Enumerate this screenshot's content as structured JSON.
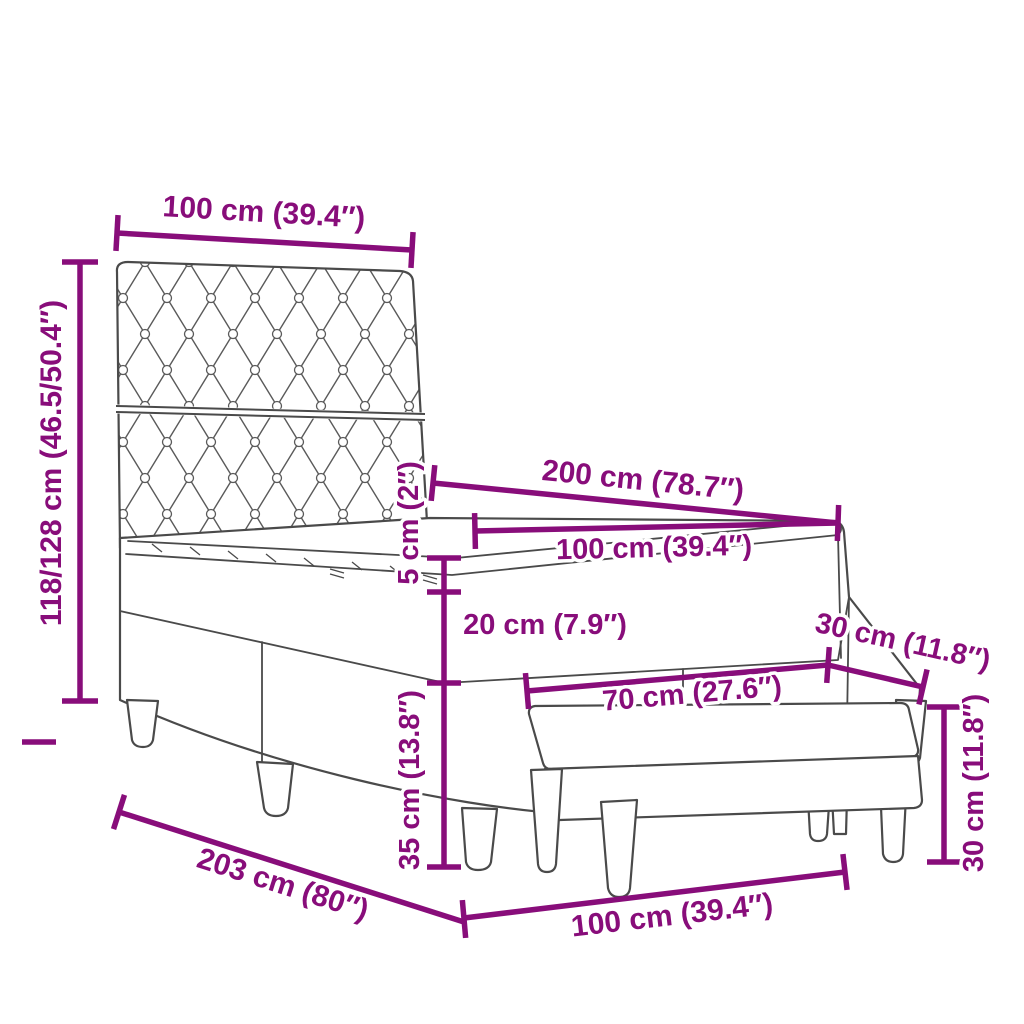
{
  "diagram": {
    "type": "product-dimension-diagram",
    "subject": "box spring bed with tufted headboard, mattress, topper and upholstered bench",
    "accent_color": "#880D7A",
    "outline_color": "#4A4A4A",
    "background_color": "#FFFFFF"
  },
  "dimensions": {
    "headboard_width": "100 cm (39.4″)",
    "headboard_height": "118/128 cm (46.5/50.4″)",
    "bed_length": "200 cm (78.7″)",
    "mattress_width": "100 cm (39.4″)",
    "topper_height": "5 cm (2″)",
    "mattress_height": "20 cm (7.9″)",
    "bench_depth": "30 cm (11.8″)",
    "bench_width": "70 cm (27.6″)",
    "base_height": "35 cm (13.8″)",
    "bench_height": "30 cm (11.8″)",
    "total_length": "203 cm (80″)",
    "bed_width": "100 cm (39.4″)"
  }
}
